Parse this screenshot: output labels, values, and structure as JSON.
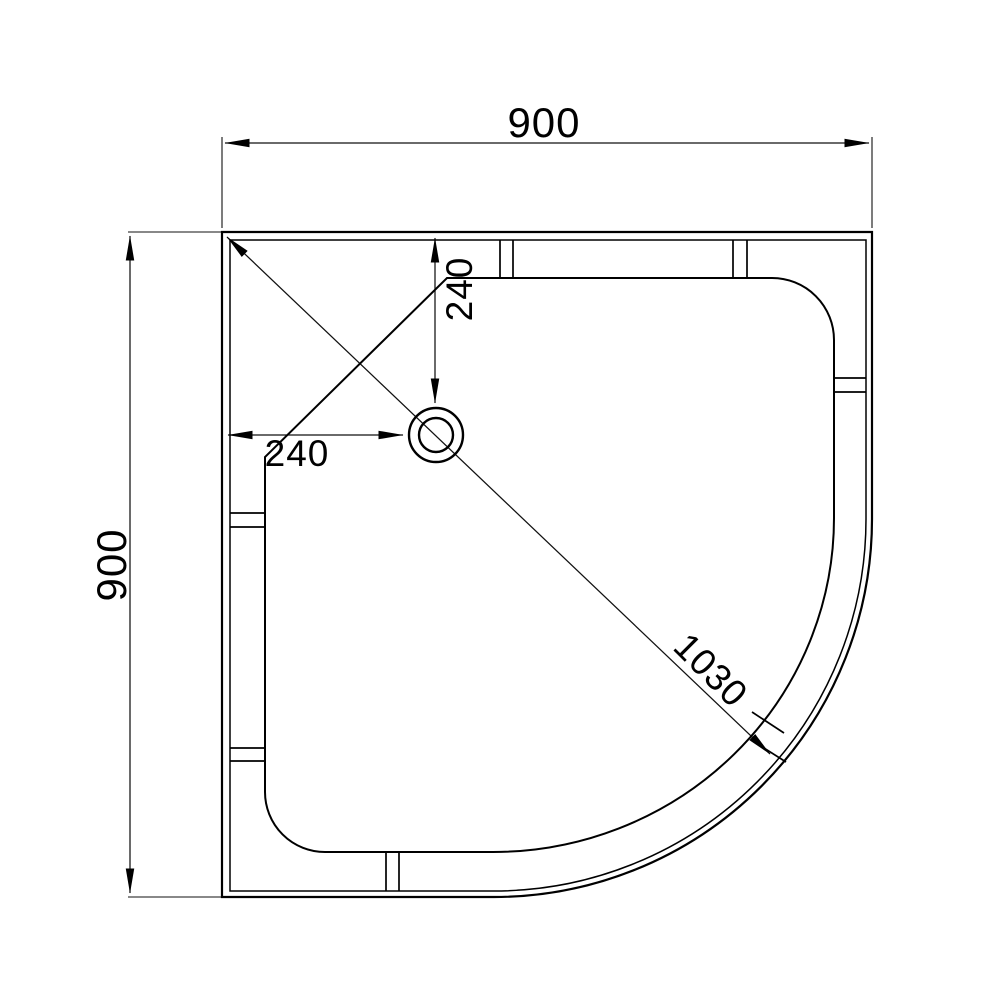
{
  "drawing": {
    "description": "Quadrant shower tray plan view technical drawing with drain position",
    "canvas": {
      "background": "#ffffff",
      "line_color": "#000000"
    },
    "dimensions": {
      "overall_width": "900",
      "overall_depth": "900",
      "drain_offset_from_top": "240",
      "drain_offset_from_left": "240",
      "corner_diagonal": "1030"
    }
  }
}
